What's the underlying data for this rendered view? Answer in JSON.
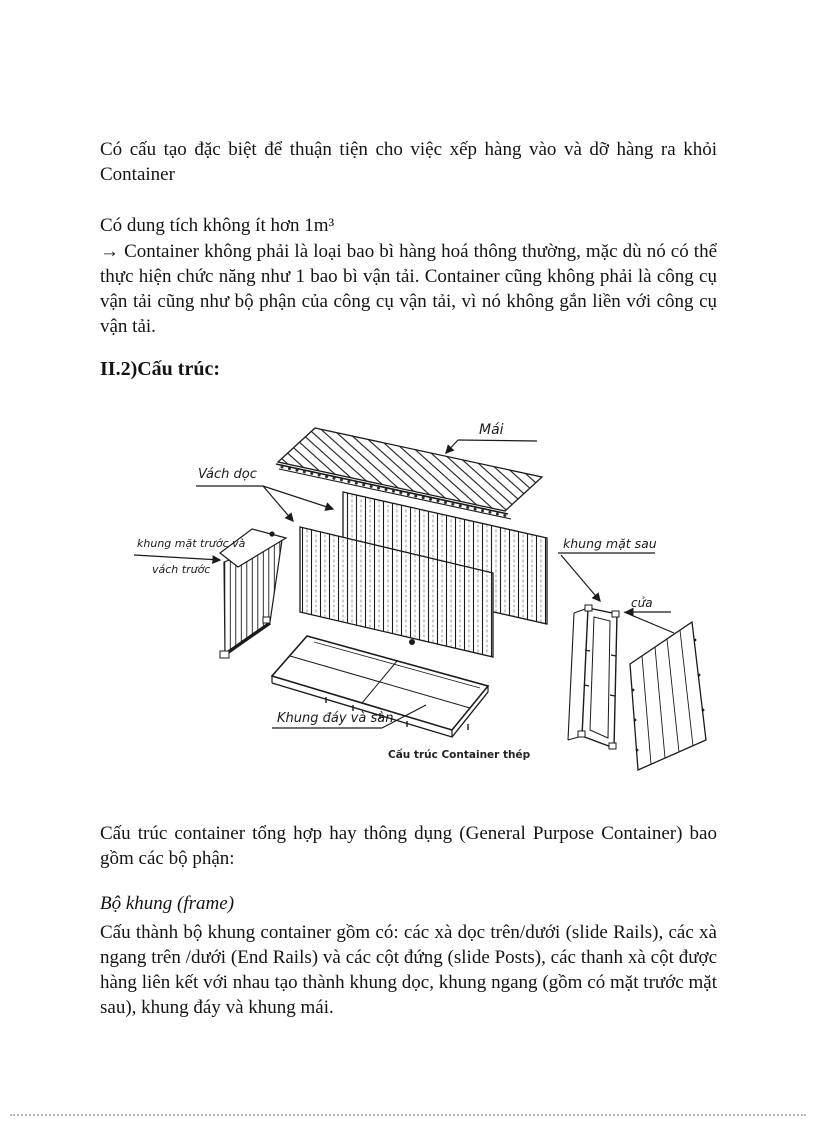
{
  "document": {
    "body_text": {
      "p1": "Có cấu tạo đặc biệt để thuận tiện cho việc xếp hàng vào và dỡ hàng ra khỏi Container",
      "p2": "Có dung tích không ít hơn 1m³",
      "p3": "→ Container không phải là loại bao bì hàng hoá thông thường, mặc dù nó có thể thực hiện chức năng như 1 bao bì vận tải. Container cũng không phải là công cụ vận tải cũng như bộ phận của công cụ vận tải, vì nó không gắn liền với công cụ vận tải.",
      "section_heading": "II.2)Cấu trúc:",
      "p4": "Cấu trúc container tổng hợp hay thông dụng (General Purpose Container) bao gồm các bộ phận:",
      "frame_heading": "Bộ khung (frame)",
      "p5": "Cấu thành bộ khung container gồm có: các xà dọc trên/dưới (slide Rails), các xà ngang trên /dưới (End Rails) và các cột đứng (slide Posts), các thanh xà cột được hàng liên kết với nhau tạo thành khung dọc, khung ngang (gồm có mặt trước mặt sau), khung đáy và khung mái."
    },
    "figure": {
      "caption": "Cấu trúc Container thép",
      "labels": {
        "roof": "Mái",
        "side_wall": "Vách dọc",
        "front_frame_1": "khung mặt trước và",
        "front_frame_2": "vách trước",
        "rear_frame": "khung mặt sau",
        "door": "cửa",
        "bottom_frame": "Khung đáy và sàn"
      }
    },
    "colors": {
      "ink": "#1b1b1b",
      "paper": "#ffffff"
    }
  }
}
